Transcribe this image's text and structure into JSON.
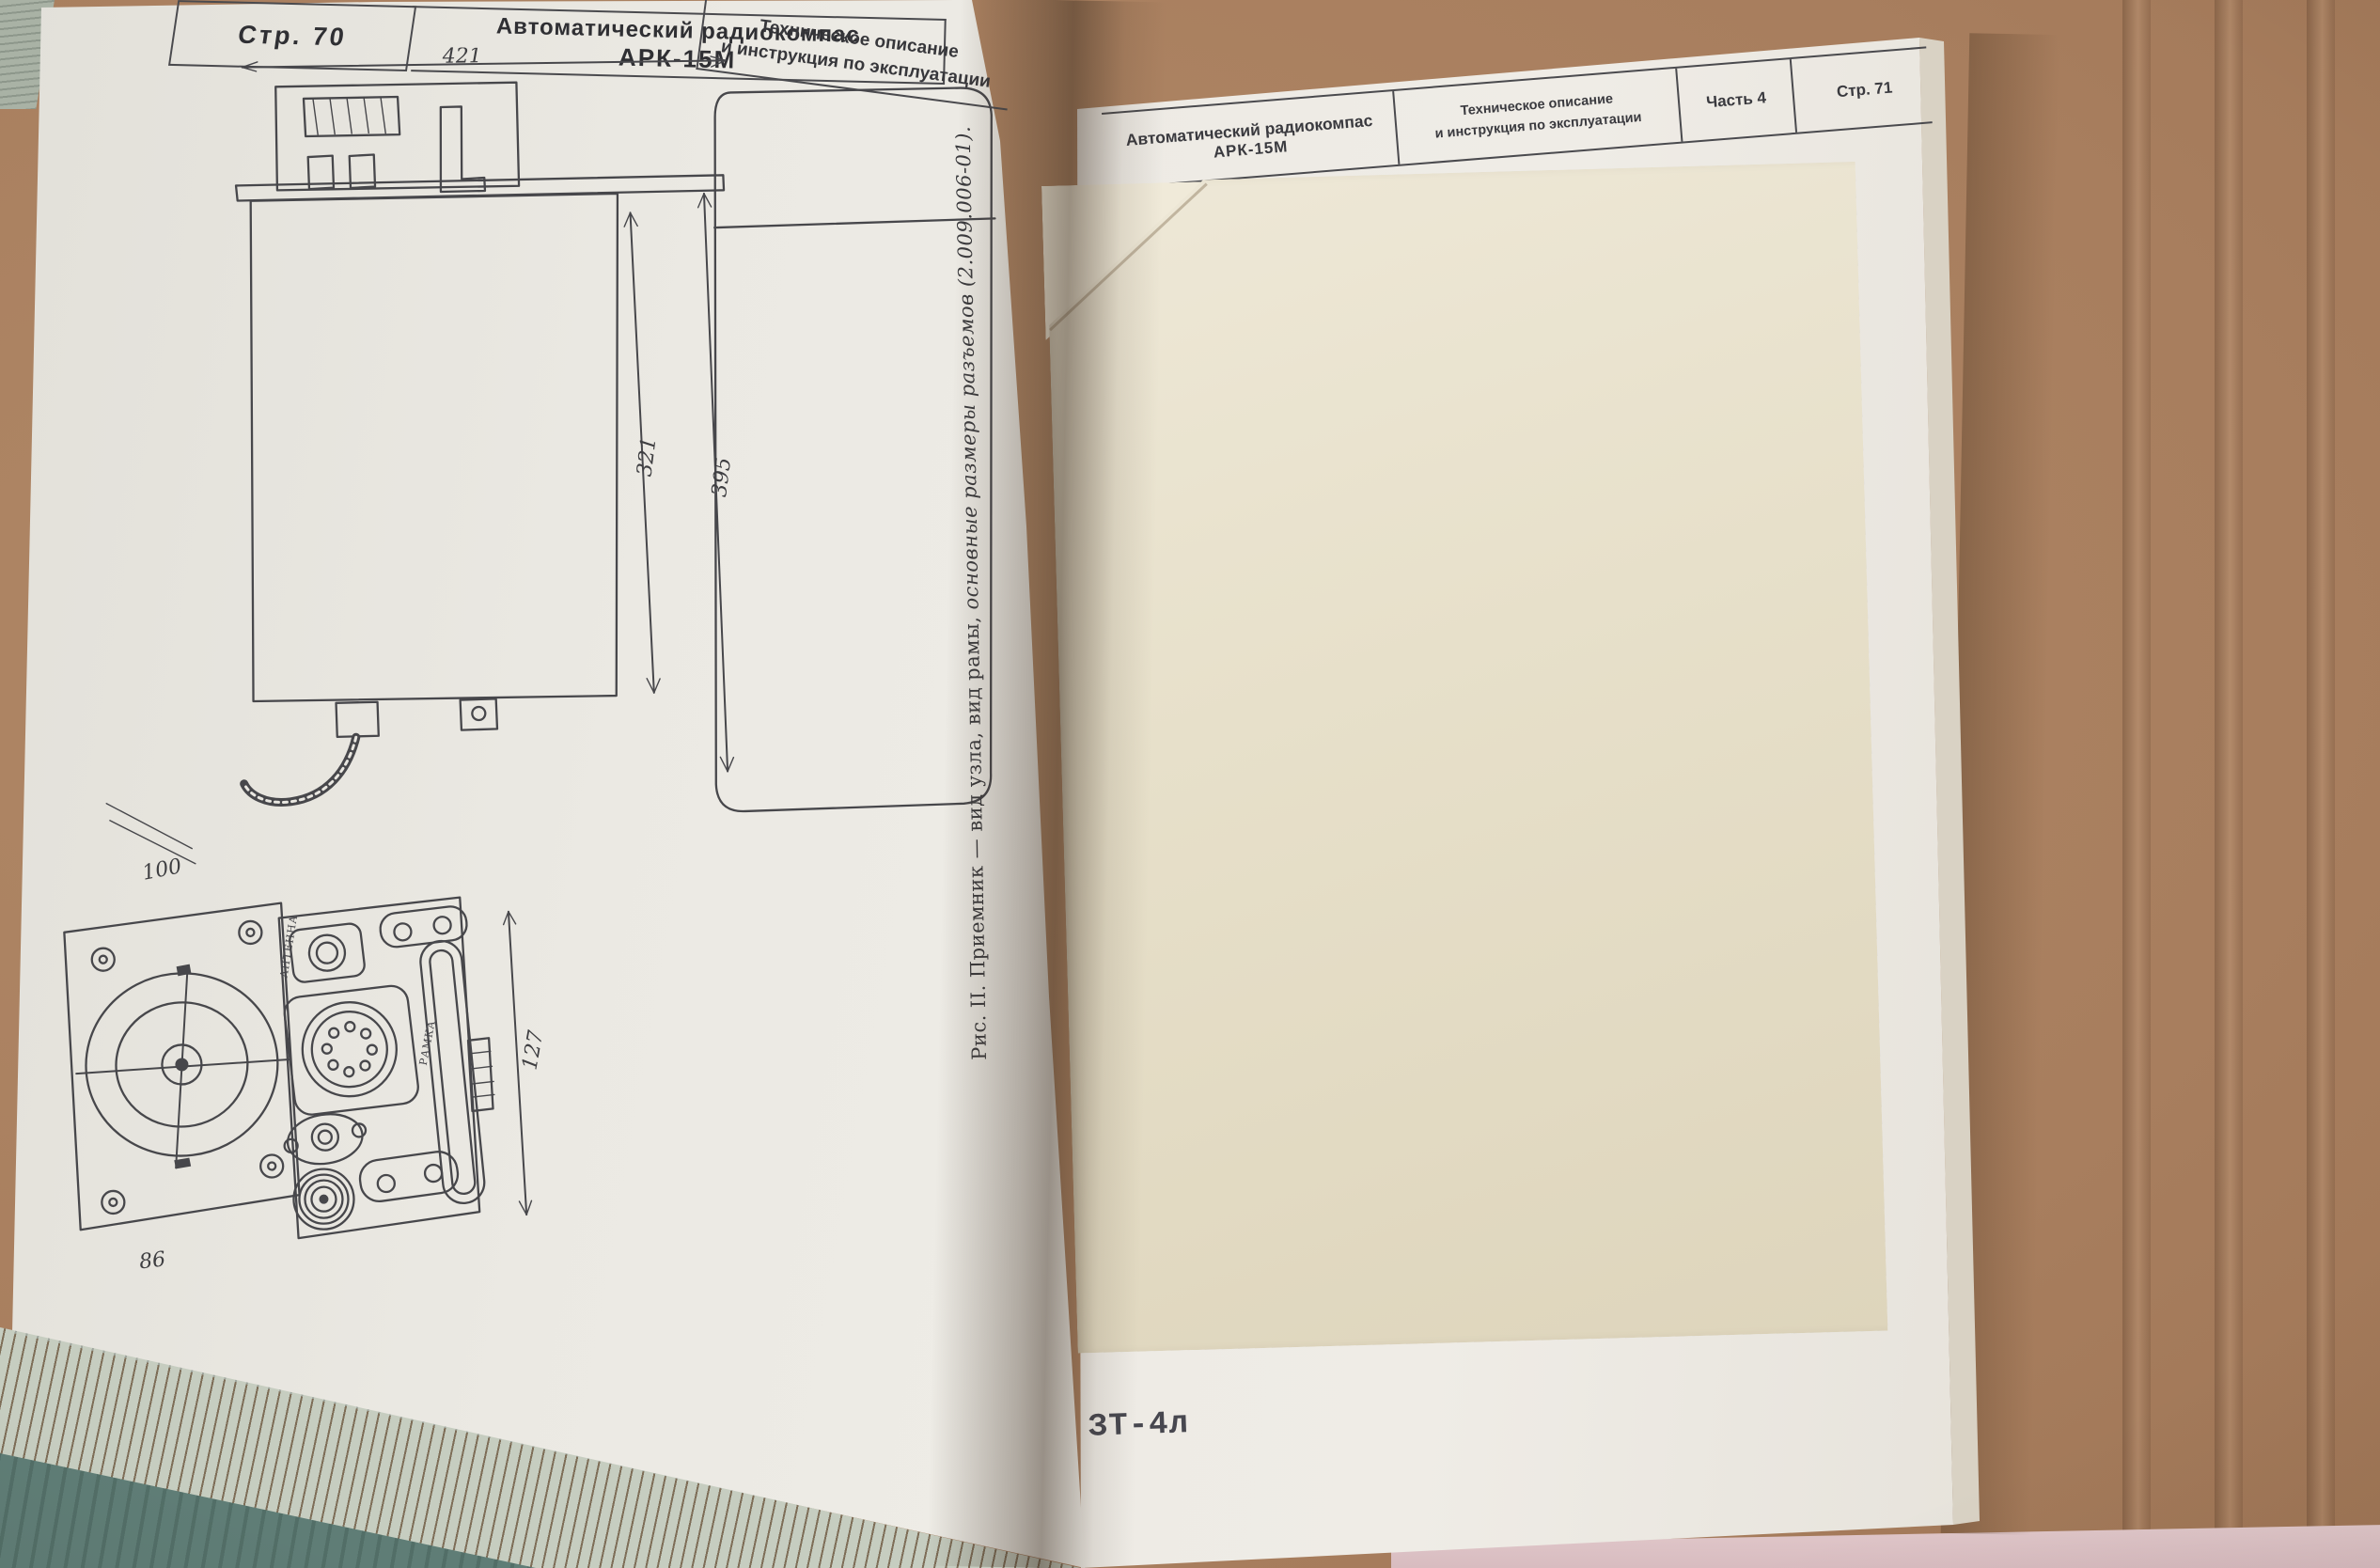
{
  "left_page": {
    "header": {
      "page_label": "Стр. 70",
      "title_line1": "Автоматический радиокомпас",
      "title_line2": "АРК-15М",
      "subtitle_line1": "Техническое описание",
      "subtitle_line2": "и инструкция по эксплуатации"
    },
    "drawing": {
      "dim_top_width": "421",
      "dim_inner_height": "321",
      "dim_outer_height": "395",
      "dim_bottom_width": "100",
      "dim_panel_height": "127",
      "dim_panel_width": "86",
      "label_antenna": "АНТЕННА",
      "label_loop": "РАМКА"
    },
    "caption_part1": "Рис. II. Приемник — вид узла, вид рамы, ",
    "caption_part2": "основные размеры разъемов (2.009.006-01)."
  },
  "right_page": {
    "header": {
      "title_line1": "Автоматический радиокомпас",
      "title_line2": "АРК-15М",
      "subtitle_line1": "Техническое описание",
      "subtitle_line2": "и инструкция по эксплуатации",
      "part_label": "Часть 4",
      "page_label": "Стр. 71"
    },
    "footer_code": "ЗТ-4л"
  },
  "colors": {
    "table_surface": "#a87e5e",
    "page_white": "#ebe9e3",
    "insert_sheet": "#e7e0ca",
    "book_edge_green": "#a9b2a5",
    "book_edge_teal": "#5f7d76",
    "ink": "#47474b"
  }
}
